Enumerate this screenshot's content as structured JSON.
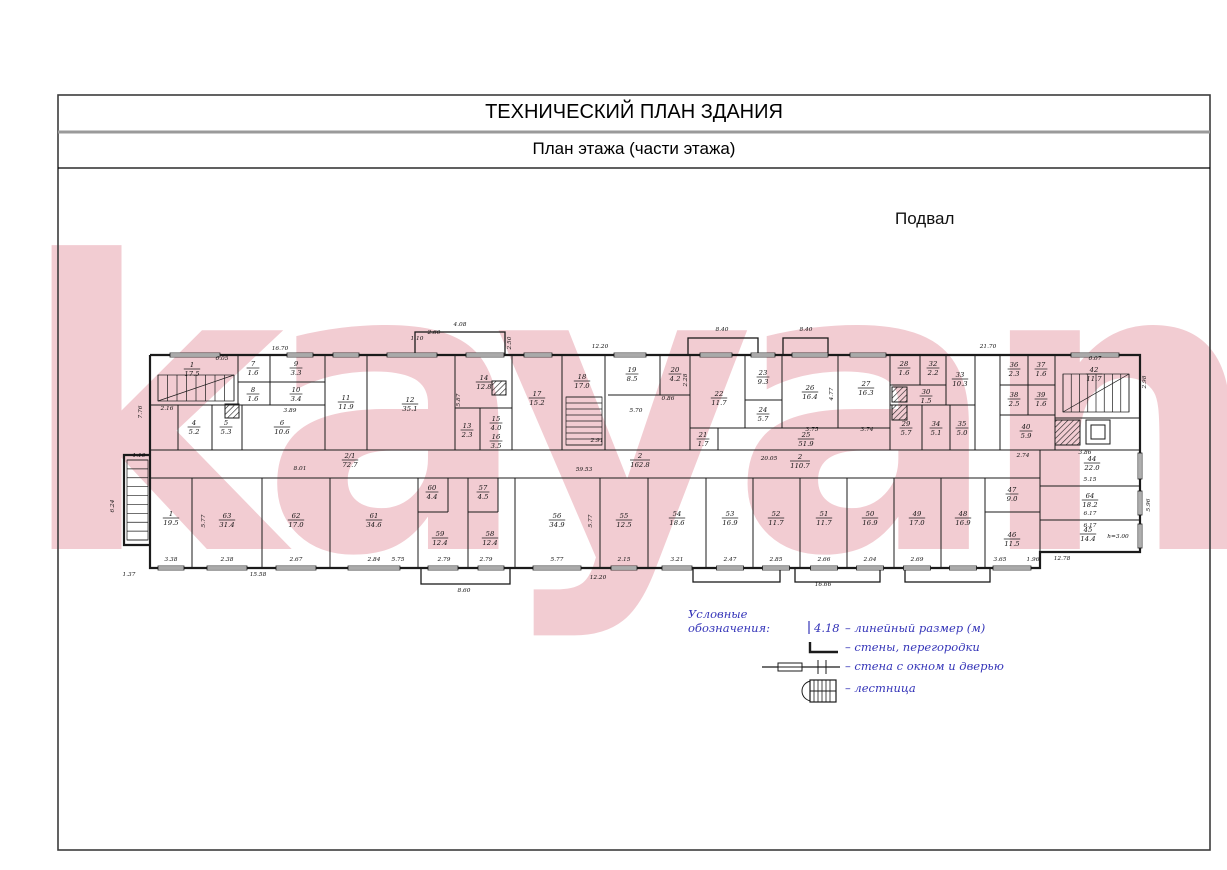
{
  "title": "ТЕХНИЧЕСКИЙ ПЛАН ЗДАНИЯ",
  "subtitle": "План этажа (части этажа)",
  "floor_label": "Подвал",
  "watermark_text": "kayan",
  "colors": {
    "legend_blue": "#3434b8",
    "wall_black": "#1b1b1b",
    "watermark_pink": "#f2ccd2"
  },
  "legend": {
    "heading": "Условные обозначения:",
    "dim_sample": "4.18",
    "items": [
      {
        "icon": "dimension-mark",
        "label": "– линейный размер (м)"
      },
      {
        "icon": "wall-corner",
        "label": "– стены, перегородки"
      },
      {
        "icon": "wall-window-door",
        "label": "– стена с окном и дверью"
      },
      {
        "icon": "staircase",
        "label": "– лестница"
      }
    ]
  },
  "plan": {
    "outline": [
      [
        [
          150,
          355
        ],
        [
          1140,
          355
        ],
        [
          1140,
          552
        ],
        [
          1040,
          552
        ],
        [
          1040,
          568
        ],
        [
          150,
          568
        ],
        [
          150,
          355
        ]
      ],
      [
        [
          150,
          455
        ],
        [
          124,
          455
        ],
        [
          124,
          545
        ],
        [
          150,
          545
        ]
      ]
    ],
    "porches": [
      [
        415,
        332,
        90,
        23
      ],
      [
        688,
        338,
        70,
        17
      ],
      [
        783,
        338,
        45,
        17
      ],
      [
        421,
        568,
        89,
        16
      ],
      [
        693,
        568,
        87,
        14
      ],
      [
        795,
        568,
        85,
        14
      ],
      [
        905,
        568,
        85,
        14
      ]
    ],
    "walls": [
      [
        238,
        355,
        238,
        405
      ],
      [
        270,
        355,
        270,
        405
      ],
      [
        325,
        355,
        325,
        450
      ],
      [
        367,
        355,
        367,
        450
      ],
      [
        455,
        355,
        455,
        450
      ],
      [
        512,
        355,
        512,
        450
      ],
      [
        562,
        355,
        562,
        450
      ],
      [
        605,
        355,
        605,
        450
      ],
      [
        660,
        355,
        660,
        395
      ],
      [
        690,
        355,
        690,
        450
      ],
      [
        745,
        355,
        745,
        428
      ],
      [
        782,
        355,
        782,
        428
      ],
      [
        838,
        355,
        838,
        428
      ],
      [
        890,
        355,
        890,
        450
      ],
      [
        920,
        355,
        920,
        385
      ],
      [
        946,
        355,
        946,
        405
      ],
      [
        975,
        355,
        975,
        450
      ],
      [
        1000,
        355,
        1000,
        450
      ],
      [
        1028,
        355,
        1028,
        415
      ],
      [
        1055,
        355,
        1055,
        450
      ],
      [
        238,
        382,
        325,
        382
      ],
      [
        150,
        405,
        325,
        405
      ],
      [
        178,
        405,
        178,
        450
      ],
      [
        212,
        405,
        212,
        450
      ],
      [
        242,
        405,
        242,
        450
      ],
      [
        455,
        408,
        512,
        408
      ],
      [
        480,
        408,
        480,
        450
      ],
      [
        608,
        395,
        690,
        395
      ],
      [
        745,
        400,
        782,
        400
      ],
      [
        690,
        428,
        890,
        428
      ],
      [
        718,
        428,
        718,
        450
      ],
      [
        890,
        385,
        946,
        385
      ],
      [
        890,
        405,
        975,
        405
      ],
      [
        922,
        405,
        922,
        450
      ],
      [
        950,
        405,
        950,
        450
      ],
      [
        1000,
        385,
        1055,
        385
      ],
      [
        1000,
        415,
        1055,
        415
      ],
      [
        1055,
        418,
        1140,
        418
      ],
      [
        150,
        450,
        1140,
        450
      ],
      [
        150,
        478,
        1040,
        478
      ],
      [
        1040,
        450,
        1040,
        568
      ],
      [
        1040,
        486,
        1140,
        486
      ],
      [
        1040,
        520,
        1140,
        520
      ],
      [
        985,
        478,
        985,
        568
      ],
      [
        985,
        512,
        1040,
        512
      ],
      [
        192,
        478,
        192,
        568
      ],
      [
        262,
        478,
        262,
        568
      ],
      [
        330,
        478,
        330,
        568
      ],
      [
        418,
        478,
        418,
        568
      ],
      [
        468,
        478,
        468,
        568
      ],
      [
        515,
        478,
        515,
        568
      ],
      [
        600,
        478,
        600,
        568
      ],
      [
        648,
        478,
        648,
        568
      ],
      [
        706,
        478,
        706,
        568
      ],
      [
        753,
        478,
        753,
        568
      ],
      [
        800,
        478,
        800,
        568
      ],
      [
        847,
        478,
        847,
        568
      ],
      [
        894,
        478,
        894,
        568
      ],
      [
        941,
        478,
        941,
        568
      ],
      [
        448,
        478,
        448,
        512
      ],
      [
        418,
        512,
        448,
        512
      ],
      [
        498,
        478,
        498,
        512
      ],
      [
        468,
        512,
        498,
        512
      ]
    ],
    "windows": [
      [
        "h",
        195,
        50,
        355
      ],
      [
        "h",
        300,
        26,
        355
      ],
      [
        "h",
        346,
        26,
        355
      ],
      [
        "h",
        412,
        50,
        355
      ],
      [
        "h",
        485,
        38,
        355
      ],
      [
        "h",
        538,
        28,
        355
      ],
      [
        "h",
        630,
        32,
        355
      ],
      [
        "h",
        716,
        32,
        355
      ],
      [
        "h",
        763,
        24,
        355
      ],
      [
        "h",
        810,
        36,
        355
      ],
      [
        "h",
        868,
        36,
        355
      ],
      [
        "h",
        1095,
        48,
        355
      ],
      [
        "h",
        171,
        26,
        568
      ],
      [
        "h",
        227,
        40,
        568
      ],
      [
        "h",
        296,
        40,
        568
      ],
      [
        "h",
        374,
        52,
        568
      ],
      [
        "h",
        443,
        30,
        568
      ],
      [
        "h",
        491,
        26,
        568
      ],
      [
        "h",
        557,
        48,
        568
      ],
      [
        "h",
        624,
        26,
        568
      ],
      [
        "h",
        677,
        30,
        568
      ],
      [
        "h",
        730,
        27,
        568
      ],
      [
        "h",
        776,
        27,
        568
      ],
      [
        "h",
        824,
        27,
        568
      ],
      [
        "h",
        870,
        27,
        568
      ],
      [
        "h",
        917,
        27,
        568
      ],
      [
        "h",
        963,
        27,
        568
      ],
      [
        "h",
        1012,
        38,
        568
      ],
      [
        "v",
        466,
        26,
        1140
      ],
      [
        "v",
        503,
        24,
        1140
      ],
      [
        "v",
        536,
        24,
        1140
      ]
    ],
    "shafts": [
      [
        225,
        404,
        14
      ],
      [
        492,
        381,
        14
      ],
      [
        892,
        387,
        15
      ],
      [
        892,
        405,
        15
      ],
      [
        1055,
        420,
        25
      ]
    ],
    "elevator": {
      "outer": [
        1086,
        420,
        24,
        24
      ],
      "inner": [
        1091,
        425,
        14,
        14
      ]
    },
    "stairs": [
      [
        "v",
        158,
        375,
        76,
        26,
        9,
        1
      ],
      [
        "h",
        566,
        397,
        36,
        48,
        9,
        0
      ],
      [
        "v",
        1063,
        374,
        66,
        38,
        9,
        1
      ],
      [
        "h",
        127,
        460,
        21,
        80,
        10,
        0
      ]
    ],
    "rooms": [
      [
        "1",
        "17.5",
        192,
        367
      ],
      [
        "7",
        "1.6",
        253,
        366
      ],
      [
        "9",
        "3.3",
        296,
        366
      ],
      [
        "8",
        "1.6",
        253,
        392
      ],
      [
        "10",
        "3.4",
        296,
        392
      ],
      [
        "4",
        "5.2",
        194,
        425
      ],
      [
        "5",
        "5.3",
        226,
        425
      ],
      [
        "6",
        "10.6",
        282,
        425
      ],
      [
        "11",
        "11.9",
        346,
        400
      ],
      [
        "12",
        "35.1",
        410,
        402
      ],
      [
        "14",
        "12.8",
        484,
        380
      ],
      [
        "13",
        "2.3",
        467,
        428
      ],
      [
        "15",
        "4.0",
        496,
        421
      ],
      [
        "16",
        "3.5",
        496,
        439
      ],
      [
        "17",
        "15.2",
        537,
        396
      ],
      [
        "18",
        "17.0",
        582,
        379
      ],
      [
        "19",
        "8.5",
        632,
        372
      ],
      [
        "20",
        "4.2",
        675,
        372
      ],
      [
        "21",
        "1.7",
        703,
        437
      ],
      [
        "22",
        "11.7",
        719,
        396
      ],
      [
        "23",
        "9.3",
        763,
        375
      ],
      [
        "24",
        "5.7",
        763,
        412
      ],
      [
        "25",
        "51.9",
        806,
        437
      ],
      [
        "26",
        "16.4",
        810,
        390
      ],
      [
        "27",
        "16.3",
        866,
        386
      ],
      [
        "28",
        "1.6",
        904,
        366
      ],
      [
        "32",
        "2.2",
        933,
        366
      ],
      [
        "33",
        "10.3",
        960,
        377
      ],
      [
        "30",
        "1.5",
        926,
        394
      ],
      [
        "29",
        "5.7",
        906,
        426
      ],
      [
        "34",
        "5.1",
        936,
        426
      ],
      [
        "35",
        "5.0",
        962,
        426
      ],
      [
        "36",
        "2.3",
        1014,
        367
      ],
      [
        "37",
        "1.6",
        1041,
        367
      ],
      [
        "38",
        "2.5",
        1014,
        397
      ],
      [
        "39",
        "1.6",
        1041,
        397
      ],
      [
        "40",
        "5.9",
        1026,
        429
      ],
      [
        "42",
        "11.7",
        1094,
        372
      ],
      [
        "44",
        "22.0",
        1092,
        461
      ],
      [
        "64",
        "18.2",
        1090,
        498
      ],
      [
        "45",
        "14.4",
        1088,
        532
      ],
      [
        "47",
        "9.0",
        1012,
        492
      ],
      [
        "46",
        "11.5",
        1012,
        537
      ],
      [
        "2/1",
        "72.7",
        350,
        458
      ],
      [
        "2",
        "162.8",
        640,
        458
      ],
      [
        "2",
        "110.7",
        800,
        459
      ],
      [
        "1",
        "19.5",
        171,
        516
      ],
      [
        "63",
        "31.4",
        227,
        518
      ],
      [
        "62",
        "17.0",
        296,
        518
      ],
      [
        "61",
        "34.6",
        374,
        518
      ],
      [
        "60",
        "4.4",
        432,
        490
      ],
      [
        "59",
        "12.4",
        440,
        536
      ],
      [
        "57",
        "4.5",
        483,
        490
      ],
      [
        "58",
        "12.4",
        490,
        536
      ],
      [
        "56",
        "34.9",
        557,
        518
      ],
      [
        "55",
        "12.5",
        624,
        518
      ],
      [
        "54",
        "18.6",
        677,
        516
      ],
      [
        "53",
        "16.9",
        730,
        516
      ],
      [
        "52",
        "11.7",
        776,
        516
      ],
      [
        "51",
        "11.7",
        824,
        516
      ],
      [
        "50",
        "16.9",
        870,
        516
      ],
      [
        "49",
        "17.0",
        917,
        516
      ],
      [
        "48",
        "16.9",
        963,
        516
      ]
    ],
    "dims": [
      [
        "16.70",
        280,
        350
      ],
      [
        "4.08",
        460,
        326
      ],
      [
        "2.60",
        434,
        334
      ],
      [
        "1.10",
        417,
        340
      ],
      [
        "2.50",
        511,
        343,
        1
      ],
      [
        "12.20",
        600,
        348
      ],
      [
        "8.40",
        722,
        331
      ],
      [
        "8.40",
        806,
        331
      ],
      [
        "21.70",
        988,
        348
      ],
      [
        "6.07",
        1095,
        360
      ],
      [
        "2.98",
        1146,
        382,
        1
      ],
      [
        "7.76",
        142,
        412,
        1
      ],
      [
        "2.16",
        167,
        410
      ],
      [
        "6.05",
        222,
        360
      ],
      [
        "3.89",
        290,
        412
      ],
      [
        "1.10",
        139,
        457
      ],
      [
        "6.24",
        114,
        506,
        1
      ],
      [
        "1.37",
        129,
        576
      ],
      [
        "5.87",
        460,
        400,
        1
      ],
      [
        "2.91",
        597,
        442
      ],
      [
        "5.70",
        636,
        412
      ],
      [
        "0.86",
        668,
        400
      ],
      [
        "2.28",
        687,
        380,
        1
      ],
      [
        "4.77",
        833,
        394,
        1
      ],
      [
        "3.75",
        812,
        431
      ],
      [
        "3.74",
        867,
        431
      ],
      [
        "8.01",
        300,
        470
      ],
      [
        "59.53",
        584,
        471
      ],
      [
        "20.05",
        769,
        460
      ],
      [
        "2.74",
        1023,
        457
      ],
      [
        "3.86",
        1085,
        454
      ],
      [
        "5.15",
        1090,
        481
      ],
      [
        "6.17",
        1090,
        515
      ],
      [
        "6.17",
        1090,
        527
      ],
      [
        "5.96",
        1150,
        505,
        1
      ],
      [
        "12.78",
        1062,
        560
      ],
      [
        "5.77",
        205,
        521,
        1
      ],
      [
        "5.77",
        592,
        521,
        1
      ],
      [
        "3.38",
        171,
        561
      ],
      [
        "2.38",
        227,
        561
      ],
      [
        "2.67",
        296,
        561
      ],
      [
        "2.84",
        374,
        561
      ],
      [
        "5.75",
        398,
        561
      ],
      [
        "2.79",
        444,
        561
      ],
      [
        "2.79",
        486,
        561
      ],
      [
        "5.77",
        557,
        561
      ],
      [
        "2.15",
        624,
        561
      ],
      [
        "3.21",
        677,
        561
      ],
      [
        "2.47",
        730,
        561
      ],
      [
        "2.85",
        776,
        561
      ],
      [
        "2.66",
        824,
        561
      ],
      [
        "2.04",
        870,
        561
      ],
      [
        "2.69",
        917,
        561
      ],
      [
        "3.65",
        1000,
        561
      ],
      [
        "1.96",
        1033,
        561
      ],
      [
        "15.58",
        258,
        576
      ],
      [
        "8.60",
        464,
        592
      ],
      [
        "12.20",
        598,
        579
      ],
      [
        "16.66",
        823,
        586
      ]
    ],
    "notes": [
      [
        "h=3.00",
        1118,
        538
      ]
    ]
  }
}
